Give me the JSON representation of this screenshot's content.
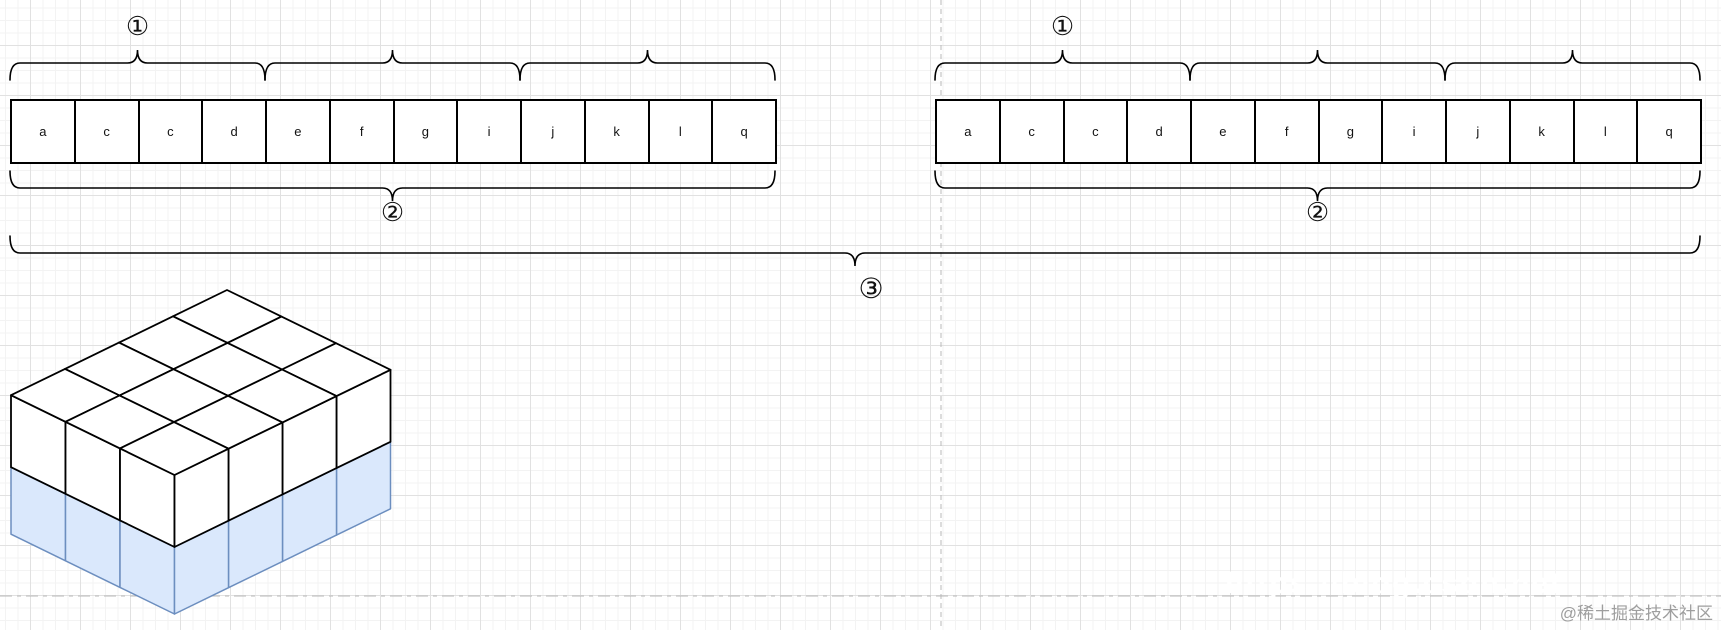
{
  "canvas": {
    "width": 1721,
    "height": 630
  },
  "colors": {
    "background": "#ffffff",
    "grid_minor": "#f3f3f3",
    "grid_major": "#e1e1e1",
    "guide": "#b9b9b9",
    "shape_stroke": "#000000",
    "cell_fill": "#ffffff",
    "cube_top_fill": "#ffffff",
    "cube_bottom_fill": "#dae8fc",
    "cube_bottom_stroke": "#6c8ebf",
    "letter_color": "#111111",
    "watermark_gray": "#9e9e9e",
    "watermark_white": "#ffffff"
  },
  "guides": {
    "vertical_x": 941,
    "horizontal_y": 596
  },
  "array_geom": {
    "y": 99,
    "cell_w": 63.75,
    "cell_h": 65,
    "top_brace_y": 63,
    "bottom_brace_y": 188,
    "top_label_y": 26,
    "bottom_label_y": 212
  },
  "groups": [
    {
      "x": 10,
      "cells": [
        "a",
        "c",
        "c",
        "d",
        "e",
        "f",
        "g",
        "i",
        "j",
        "k",
        "l",
        "q"
      ],
      "cells_per_brace": 4,
      "top_label": "①",
      "bottom_label": "②"
    },
    {
      "x": 935,
      "cells": [
        "a",
        "c",
        "c",
        "d",
        "e",
        "f",
        "g",
        "i",
        "j",
        "k",
        "l",
        "q"
      ],
      "cells_per_brace": 4,
      "top_label": "①",
      "bottom_label": "②"
    }
  ],
  "overall_brace": {
    "label": "③",
    "x0": 10,
    "x1": 1700,
    "y": 253,
    "label_x": 871,
    "label_y": 289
  },
  "cube": {
    "apex_x": 227,
    "apex_y": 290,
    "right_dx": 54.5,
    "right_dy": 26.6,
    "left_dx": -54.0,
    "left_dy": 26.3,
    "cols_right": 3,
    "cols_left": 4,
    "top_height": 72,
    "bottom_height": 67
  },
  "watermarks": {
    "community": "@稀土掘金技术社区",
    "url": "https://blog.csdn.net"
  }
}
